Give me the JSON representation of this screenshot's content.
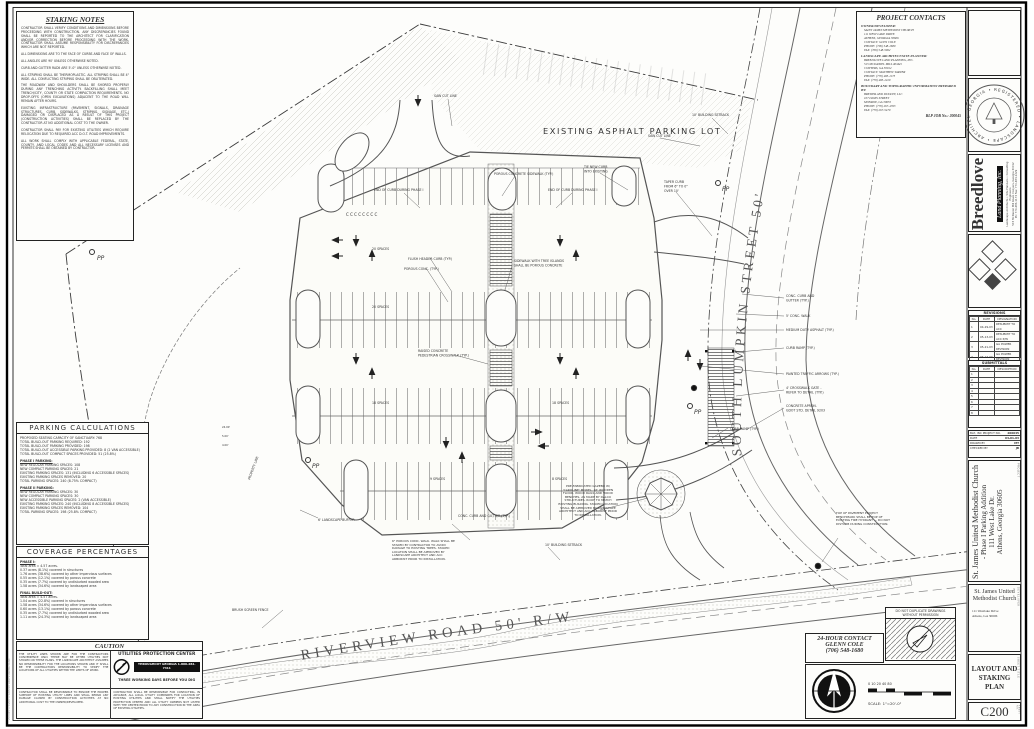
{
  "sheet": {
    "number": "C200",
    "title": "LAYOUT AND STAKING PLAN",
    "edge_note": "200045 — C200 — LAYOUT AND STAKING PLAN"
  },
  "staking_notes": {
    "title": "STAKING NOTES",
    "paragraphs": [
      "CONTRACTOR SHALL VERIFY CONDITIONS AND DIMENSIONS BEFORE PROCEEDING WITH CONSTRUCTION. ANY DISCREPANCIES FOUND SHALL BE REPORTED TO THE ARCHITECT FOR CLARIFICATION AND/OR CORRECTION BEFORE PROCEEDING WITH THE WORK. CONTRACTOR SHALL ASSUME RESPONSIBILITY FOR DISCREPANCIES WHICH ARE NOT REPORTED.",
      "ALL DIMENSIONS ARE TO THE FACE OF CURBS AND FACE OF WALLS.",
      "ALL ANGLES ARE 90' UNLESS OTHERWISE NOTED.",
      "CURB AND GUTTER RADII ARE 5'-0\" UNLESS OTHERWISE NOTED.",
      "ALL STRIPING SHALL BE THERMOPLASTIC. ALL STRIPING SHALL BE 4\" WIDE. ALL CONFLICTING STRIPING SHALL BE OBLITERATED.",
      "THE ROADWAY AND SHOULDERS SHALL BE SHORED PROPERLY DURING ANY TRENCHING ACTIVITY. BACKFILLING SHALL MEET TRENCH/CITY, COUNTY OR STATE COMPACTION REQUIREMENTS. NO DROP-OFFS (OPEN EXCAVATIONS) ADJACENT TO THE ROAD WILL REMAIN AFTER HOURS.",
      "EXISTING INFRASTRUCTURE (PAVEMENT, SIGNALS, DRAINAGE STRUCTURES, CURB, SIDEWALKS, STRIPING, SIGNAGE, ETC.) DAMAGED OR DISPLACED AS A RESULT OF THIS PROJECT (CONSTRUCTION ACTIVITIES) SHALL BE REPLACED BY THE CONTRACTOR AT NO ADDITIONAL COST TO THE OWNER.",
      "CONTRACTOR SHALL PAY FOR EXISTING UTILITIES WHICH REQUIRE RELOCATION DUE TO REQUIRED ACC D.O.T. ROAD IMPROVEMENTS.",
      "ALL WORK SHALL COMPLY WITH APPLICABLE FEDERAL, STATE, COUNTY, AND LOCAL CODES AND ALL NECESSARY LICENSES AND PERMITS SHALL BE OBTAINED BY CONTRACTOR."
    ]
  },
  "project_contacts": {
    "title": "PROJECT CONTACTS",
    "owner_heading": "OWNER/DEVELOPER:",
    "owner_lines": [
      "SAINT JAMES METHODIST CHURCH",
      "111 WEST LAKE DRIVE",
      "ATHENS, GEORGIA 30606",
      "CONTACT: GLEN COLE",
      "PHONE: (706) 548-1680",
      "FAX: (706) 548-5962"
    ],
    "la_heading": "LANDSCAPE ARCHITECT/SITE PLANNER:",
    "la_lines": [
      "BREEDLOVE LAND PLANNING, INC.",
      "515 MCDANIEL MILL ROAD",
      "CONYERS, GA 30012",
      "CONTACT: MATTHEW TARVER",
      "PHONE: (770) 483-1173",
      "FAX: (770) 483-1229"
    ],
    "survey_heading": "BOUNDARY AND TOPOGRAPHIC INFORMATION PREPARED BY:",
    "survey_lines": [
      "BREWER AND DUDLEY, LLC",
      "107 DAVIS STREET",
      "MONROE, GA 30655",
      "PHONE: (770) 267-4763",
      "FAX: (770) 267-5479"
    ],
    "job_no": "BLP JOB No.:  200045"
  },
  "parking_calculations": {
    "title": "PARKING CALCULATIONS",
    "summary": [
      "PROPOSED SEATING CAPACITY OF SANCTUARY: 768",
      "TOTAL BUILD-OUT PARKING REQUIRED: 192",
      "TOTAL BUILD-OUT PARKING PROVIDED: 198",
      "TOTAL BUILD-OUT ACCESSIBLE PARKING PROVIDED: 8 (2 VAN ACCESSIBLE)",
      "TOTAL BUILD-OUT COMPACT SPACES PROVIDED: 51 (25.8%)"
    ],
    "phase1_header": "PHASE I PARKING:",
    "phase1": [
      "NEW REGULAR PARKING SPACES: 108",
      "NEW COMPACT PARKING SPACES: 21",
      "EXISTING PARKING SPACES: 131 (INCLUDING 6 ACCESSIBLE SPACES)",
      "EXISTING PARKING SPACES REMOVED: 20",
      "TOTAL PARKING SPACES: 240 (8.75% COMPACT)"
    ],
    "phase2_header": "PHASE II PARKING:",
    "phase2": [
      "NEW REGULAR PARKING SPACES: 30",
      "NEW COMPACT PARKING SPACES: 30",
      "NEW ACCESSIBLE PARKING SPACES: 2 (VAN ACCESSIBLE)",
      "EXISTING PARKING SPACES: 240 (INCLUDING 8 ACCESSIBLE SPACES)",
      "EXISTING PARKING SPACES REMOVED: 104",
      "TOTAL PARKING SPACES: 198 (25.8% COMPACT)"
    ]
  },
  "coverage": {
    "title": "COVERAGE PERCENTAGES",
    "phase1_header": "PHASE I:",
    "phase1": [
      "Total area = 4.57 acres.",
      "0.37 acres (8.1%) covered in structures",
      "1.76 acres (38.6%) covered by other impervious surfaces",
      "0.55 acres (12.1%) covered by porous concrete",
      "0.35 acres (7.7%) covered by undisturbed wooded area",
      "1.58 acres (34.6%) covered by landscaped area"
    ],
    "final_header": "FINAL BUILD-OUT:",
    "final": [
      "Total area = 4.57 acres.",
      "1.04 acres (22.8%) covered in structures",
      "1.58 acres (34.6%) covered by other impervious surfaces",
      "0.60 acres (13.1%) covered by porous concrete",
      "0.35 acres (7.7%) covered by undisturbed wooded area",
      "1.11 acres (24.3%) covered by landscaped area"
    ]
  },
  "caution": {
    "title": "CAUTION",
    "p1": "THE UTILITY LINES SHOWN ARE FOR THE CONTRACTORS CONVENIENCE ONLY. THERE MAY BE OTHER UTILITIES NOT SHOWN ON THESE PLANS. THE LANDSCAPE ARCHITECT ASSUMES NO RESPONSIBILITY FOR THE LOCATIONS SHOWN AND IT SHALL BE THE CONTRACTORS RESPONSIBILITY TO VERIFY THE LOCATIONS OF ALL UTILITIES WITHIN THE LIMITS OF WORK.",
    "p2": "CONTRACTOR SHALL BE RESPONSIBLE TO ENSURE THE PROPER SUPPORT OF EXISTING UTILITY LINES AND SHALL REPAIR ANY DAMAGE CAUSED BY CONSTRUCTION ACTIVITIES AT NO ADDITIONAL COST TO THE OWNER/DEVELOPER.",
    "p3": "CONTRACTOR SHALL BE RESPONSIBLE FOR CONTACTING, IN ADVANCE, ALL LOCAL UTILITY COMPANIES FOR LOCATION OF EXISTING UTILITIES AND SHALL NOTIFY THE UTILITIES PROTECTION CENTER AND ALL UTILITY OWNERS NOT LISTED WITH THE CENTER PRIOR TO ANY CONSTRUCTION IN THE AREA OF EXISTING UTILITIES.",
    "upc_title": "UTILITIES PROTECTION CENTER",
    "upc_phone": "THROUGHOUT GEORGIA 1-800-282-7411",
    "upc_tagline": "THREE WORKING DAYS BEFORE YOU DIG"
  },
  "contact24": {
    "line1": "24-HOUR CONTACT",
    "line2": "GLENN COLE",
    "line3": "(706) 548-1680"
  },
  "dnd": {
    "line1": "DO NOT DUPLICATE DRAWINGS",
    "line2": "WITHOUT PERMISSION"
  },
  "scale": {
    "text": "SCALE: 1\"=20'-0\"",
    "ticks": "0   10   20        40                  80"
  },
  "sidebar": {
    "seal_text": "GEORGIA • REGISTERED • LANDSCAPE • ARCHITECT",
    "logo": {
      "name": "Breedlove",
      "sub": "Land Planning, Inc.",
      "addr1": "Landscape Architects • Site Planners • Consulting Engineers",
      "addr2": "515 McDaniel Mill Road, Conyers, Georgia 30012",
      "addr3": "Ph: 770-483-1173   Fax: 770-483-1229"
    },
    "revisions": {
      "title": "REVISIONS",
      "cols": {
        "no": "No.",
        "date": "DATE",
        "desc": "DESIGNATION"
      },
      "rows": [
        {
          "no": "1",
          "date": "04-29-03",
          "desc": "RESUBMIT TO ACC"
        },
        {
          "no": "2",
          "date": "05-13-03",
          "desc": "RESUBMIT TO ACC P/W"
        },
        {
          "no": "3",
          "date": "05-21-03",
          "desc": "GA POWER REVISION"
        },
        {
          "no": "4",
          "date": "06-17-03",
          "desc": "GA POWER REVISION"
        },
        {
          "no": "5",
          "date": "08-25-03",
          "desc": "RE-ISSUE FOR BID"
        }
      ]
    },
    "submittals": {
      "title": "SUBMITTALS",
      "cols": {
        "no": "No.",
        "date": "DATE",
        "desc": "DESCRIPTION"
      },
      "rows": [
        "1",
        "2",
        "3",
        "4",
        "5",
        "6",
        "7",
        "8"
      ]
    },
    "info": {
      "project_no_label": "BLP, INC PROJECT NO.",
      "project_no": "200045",
      "date_label": "DATE",
      "date": "04-01-03",
      "drawn_label": "DRAWN BY",
      "drawn": "MT",
      "checked_label": "CHECKED BY",
      "checked": "JB"
    },
    "project_block": {
      "line1": "St. James United Methodist Church",
      "line2": "- Phase I Parking Addition",
      "line3": "111 West Lake Dr.",
      "line4": "Athens, Georgia 30605",
      "side": "PROJECT"
    },
    "developer_block": {
      "name1": "St. James United",
      "name2": "Methodist Church",
      "addr1": "111 Westlake Drive",
      "addr2": "Athens, GA 30606",
      "side": "DEVELOPER"
    },
    "sheet_title_block": {
      "line1": "LAYOUT AND",
      "line2": "STAKING PLAN",
      "side": "SHEET TITLE"
    },
    "sheet_no_block": {
      "number": "C200",
      "side": "SHEET NO."
    }
  },
  "plan": {
    "streets": {
      "lumpkin": "SOUTH  LUMPKIN  STREET  50'",
      "riverview": "RIVERVIEW  ROAD  50'  R/W"
    },
    "labels": {
      "existing_lot": "EXISTING ASPHALT PARKING LOT",
      "saw_cut": "SAW CUT LINE",
      "rw_cut": "SAW CUT LINE",
      "porous_sidewalk": "POROUS CONCRETE SIDEWALK (TYP.)",
      "end_curb": "END OF CURB DURING PHASE I",
      "tie_curb_1": "TIE NEW CURB",
      "tie_curb_2": "INTO EXISTING",
      "taper_1": "TAPER CURB",
      "taper_2": "FROM 6\" TO 0\"",
      "taper_3": "OVER 10'",
      "setback": "10' BUILDING SETBACK",
      "flush_curb": "FLUSH HEADER CURB (TYP.)",
      "porous_conc": "POROUS CONC. (TYP.)",
      "tree_islands_1": "SIDEWALK WITH TREE ISLANDS",
      "tree_islands_2": "SHALL BE POROUS CONCRETE",
      "raised_cross_1": "RAISED CONCRETE",
      "raised_cross_2": "PEDESTRIAN CROSSWALK (TYP.)",
      "curb_gutter_1": "CONC. CURB AND",
      "curb_gutter_2": "GUTTER (TYP.)",
      "curb_gutter_b": "CONC. CURB AND GUTTER (TYP.)",
      "conc_walk": "5' CONC. WALK",
      "med_asphalt": "MEDIUM DUTY ASPHALT (TYP.)",
      "curb_ramp": "CURB RAMP (TYP.)",
      "traffic_arrows": "PAINTED TRAFFIC ARROWS (TYP.)",
      "crosswalk_gate_1": "4' CROSSWALK GATE -",
      "crosswalk_gate_2": "REFER TO DETAIL (TYP.)",
      "apron_1": "CONCRETE APRON.",
      "apron_2": "GDOT STD. DETAIL 9203",
      "fence": "BRUSH SCREEN FENCE",
      "buffer": "6' LANDSCAPE BUFFER",
      "property_line": "PROPERTY LINE",
      "pp": "PP",
      "compact_row": "C  C  C  C  C  C  C  C",
      "spaces_1": "20 SPACES",
      "spaces_2": "20 SPACES",
      "spaces_3": "18 SPACES",
      "spaces_4": "18 SPACES",
      "spaces_5": "9 SPACES",
      "spaces_6": "8 SPACES",
      "dim_1": "24.00'",
      "dim_2": "5.00'",
      "dim_3": "4.00'"
    },
    "notes": {
      "gazebo": "PRE-FABRICATED GAZEBO W/ 'CAROLINE' MODEL, 16' WOODEN FLOOR, WOOD RAILS AND WOOD BENCHES, AS MADE BY DALCO STRUCTURES. ROOF TO MATCH EXISTING BUILDING. STAKED LOCATION SHALL BE APPROVED BY LANDSCAPE ARCHITECT AND ACC ARBORIST PRIOR TO INSTALLATION.",
      "walk": "6\" POROUS CONC. WALK. WALK SHALL BE STAKED BY CONTRACTOR TO AVOID DAMAGE TO EXISTING TREES. STAKED LOCATION SHALL BE APPROVED BY LANDSCAPE ARCHITECT AND ACC ARBORIST PRIOR TO INSTALLATION.",
      "benchmark": "TOP OF PAVEMENT PROJECT BENCHMARK SHALL BE TOP OF EXISTING FIRE HYDRANT — DO NOT DISTURB DURING CONSTRUCTION."
    }
  }
}
